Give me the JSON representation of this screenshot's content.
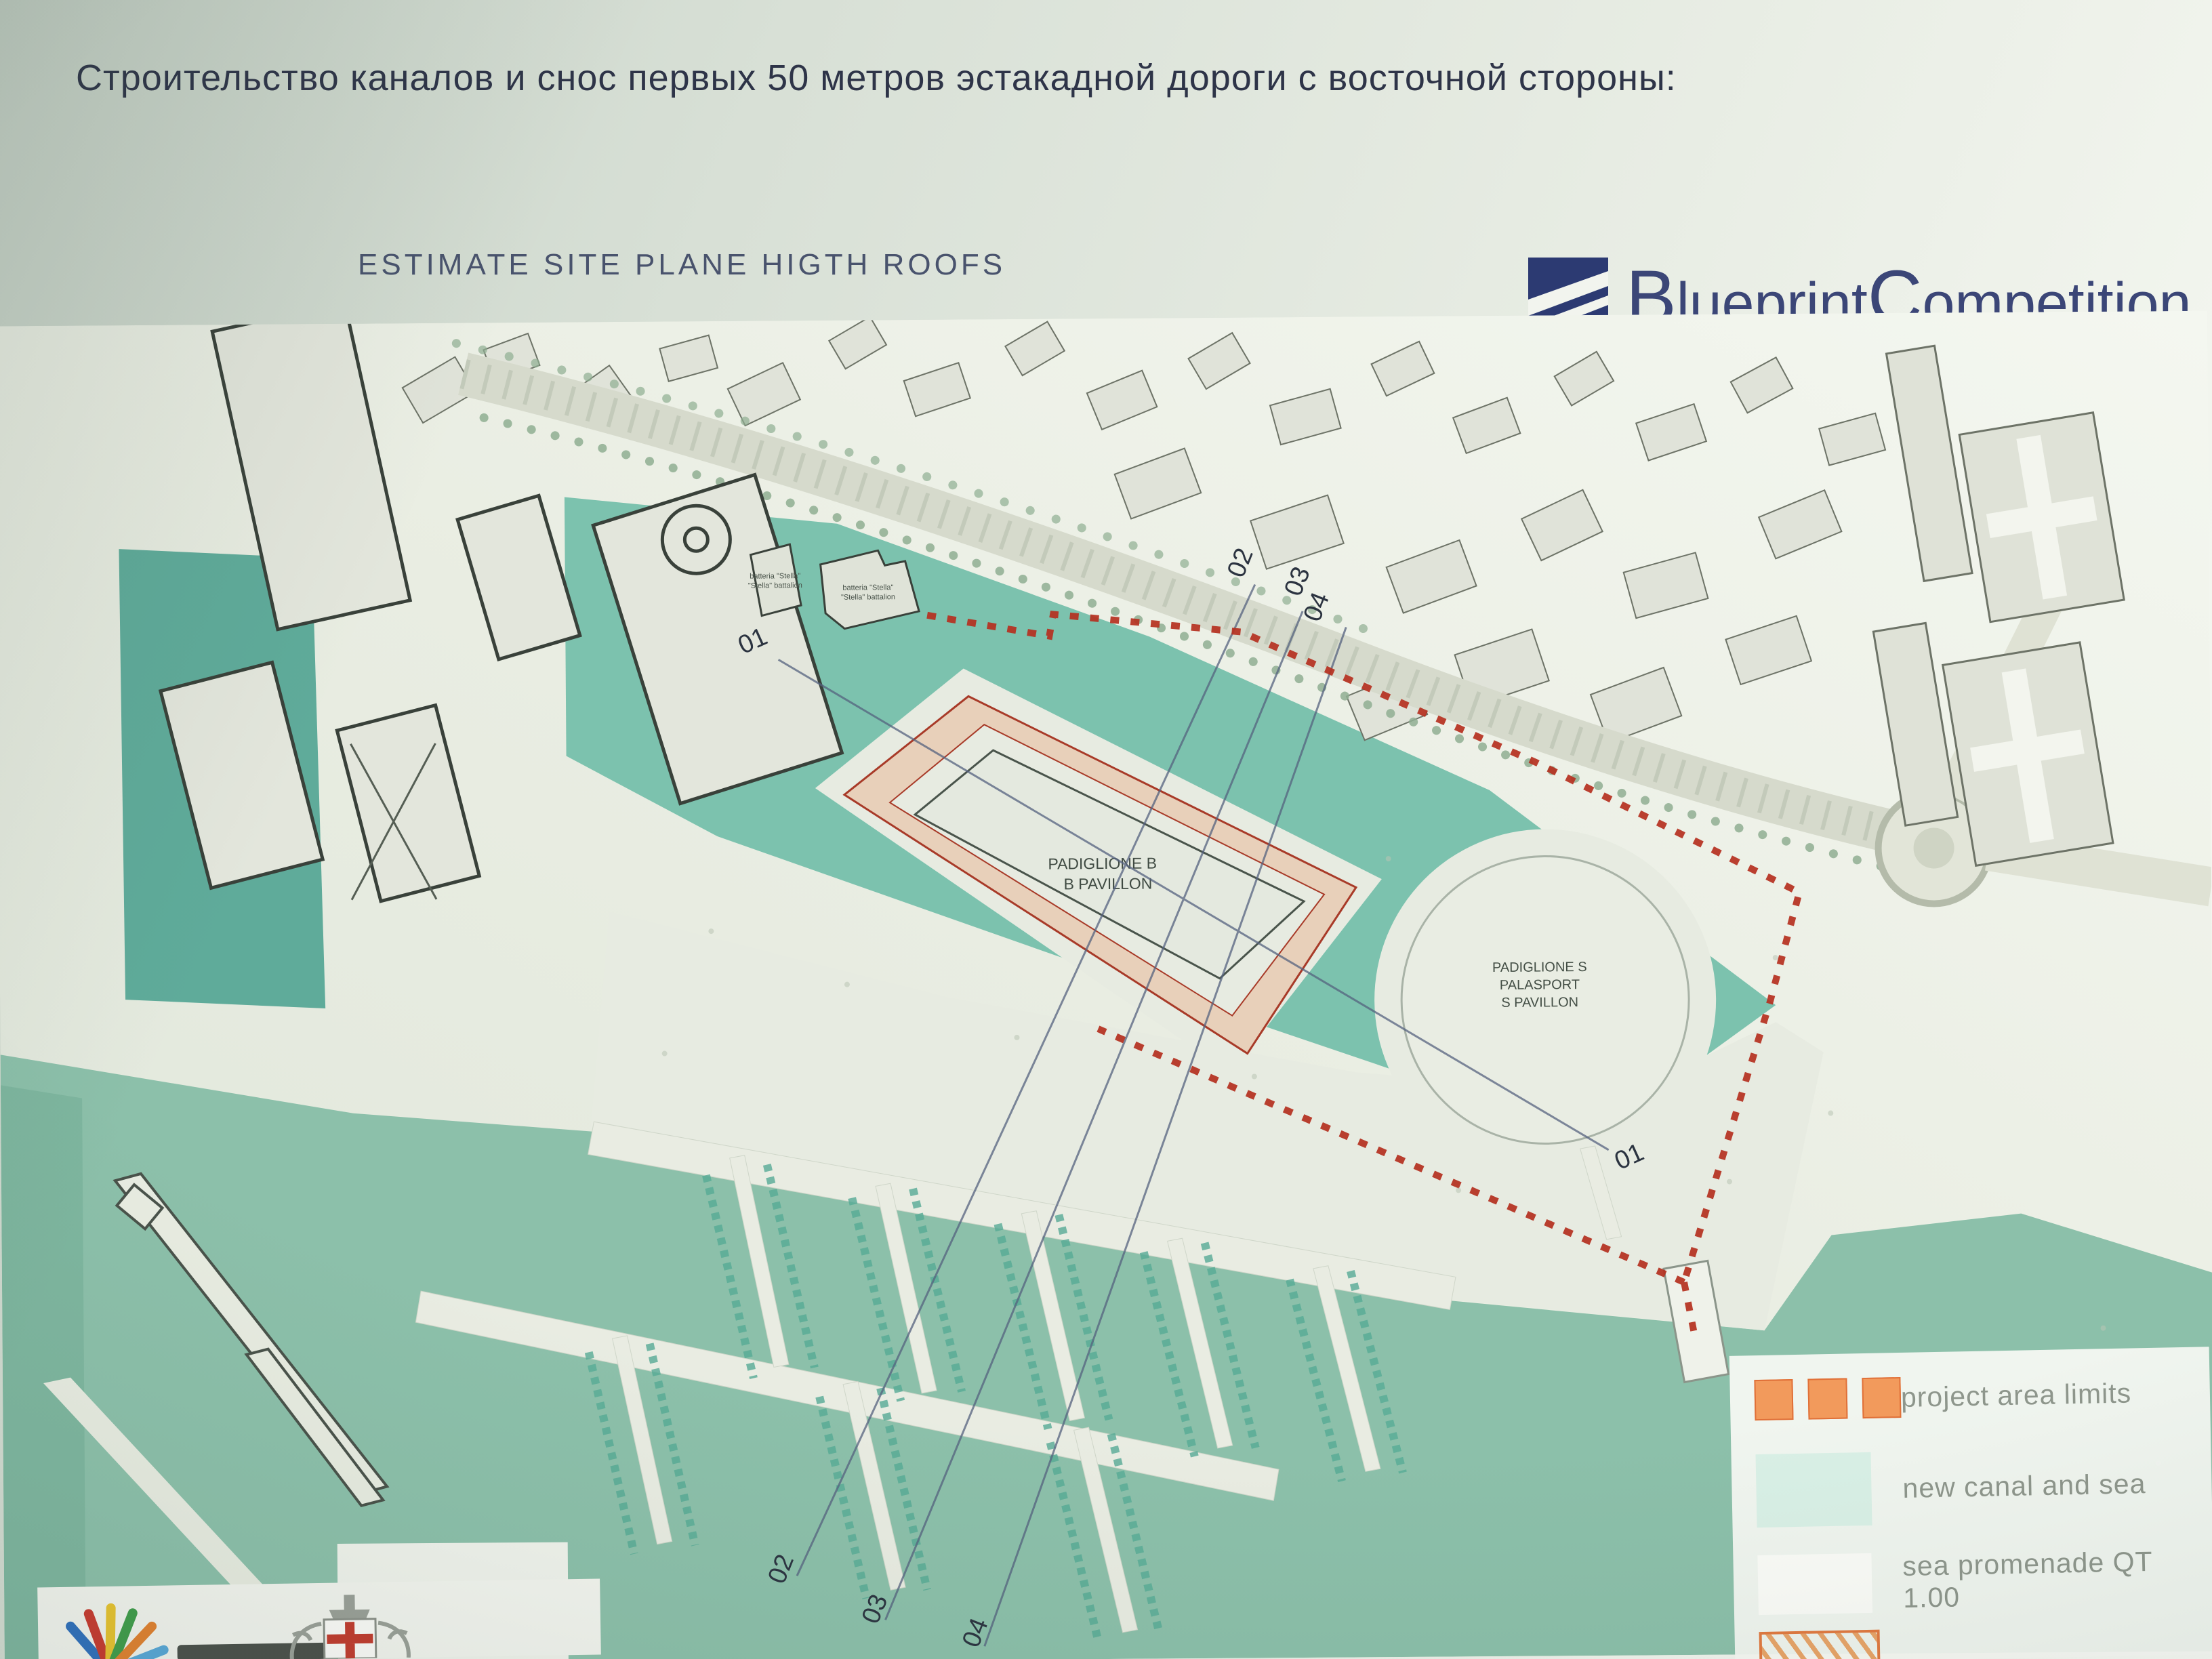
{
  "header": {
    "title": "Строительство каналов и снос первых 50 метров эстакадной дороги с восточной стороны:",
    "subtitle": "ESTIMATE SITE PLANE HIGTH ROOFS"
  },
  "brand": {
    "name": "Blueprint Competition",
    "b": "B",
    "lueprint": "lueprint",
    "c": "C",
    "ompetition": "ompetition"
  },
  "map": {
    "pavilion_b": {
      "line1": "PADIGLIONE B",
      "line2": "B PAVILLON"
    },
    "pavilion_s": {
      "line1": "PADIGLIONE S",
      "line2": "PALASPORT",
      "line3": "S PAVILLON"
    },
    "battery": {
      "line1": "batteria \"Stella\"",
      "line2": "\"Stella\" battalion"
    },
    "sections": {
      "s01": "01",
      "s02": "02",
      "s03": "03",
      "s04": "04"
    }
  },
  "legend": {
    "items": [
      {
        "label": "project area limits"
      },
      {
        "label": "new canal and sea"
      },
      {
        "label": "sea promenade QT 1.00"
      },
      {
        "label": ""
      }
    ]
  },
  "colors": {
    "accent_red": "#b5301f",
    "canal_teal": "#7cc2ae",
    "sea_teal": "#8cc0aa",
    "project_pink": "#e8d0ba",
    "brand_navy": "#2c3a72",
    "legend_orange": "#ef9659"
  }
}
